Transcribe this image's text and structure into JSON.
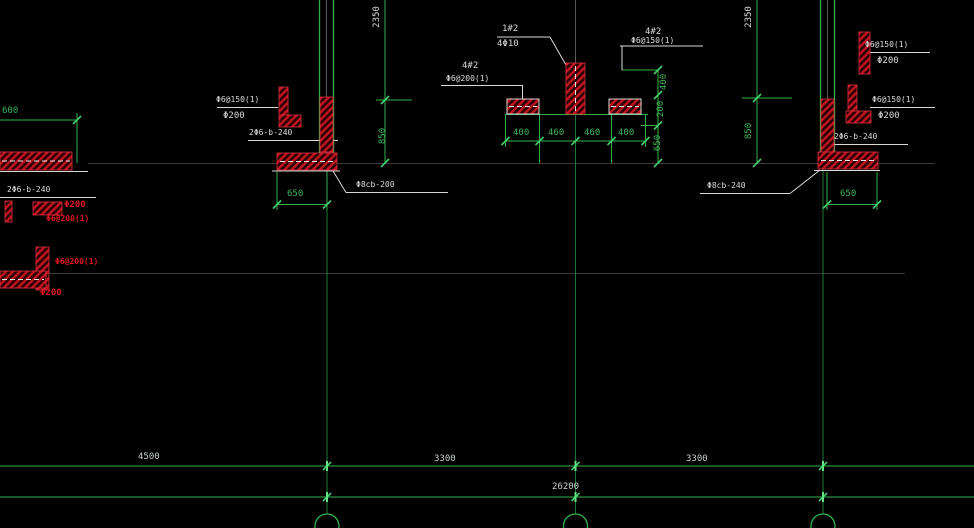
{
  "drawing": {
    "type": "cad-structural-foundation-detail",
    "palette": {
      "background": "#000000",
      "line_green": "#2fb24c",
      "axis_green_dim": "#1c7a35",
      "hatch_red": "#c41320",
      "text_white": "#dadada",
      "faint_gray": "#3c3c3c"
    }
  },
  "texts": {
    "dim_2350_left": "2350",
    "dim_2350_right": "2350",
    "dim_850_left": "850",
    "dim_850_right": "850",
    "dim_400_vert": "400",
    "dim_200_vert": "200",
    "dim_650_vert": "650",
    "dim_600": "600",
    "dim_650_left": "650",
    "dim_650_right": "650",
    "dim_400_a": "400",
    "dim_460_a": "460",
    "dim_460_b": "460",
    "dim_400_b": "400",
    "dim_4500": "4500",
    "dim_3300_left": "3300",
    "dim_3300_right": "3300",
    "dim_26200": "26200",
    "label_center_top_line1": "1#2",
    "label_center_top_line2": "4Φ10",
    "label_center_left_line1": "4#2",
    "label_center_left_line2": "Φ6@200(1)",
    "label_center_right_line1": "4#2",
    "label_center_right_line2": "Φ6@150(1)",
    "label_left_column_line1": "Φ6@150(1)",
    "label_left_column_line2": "Φ200",
    "label_right_column_line1": "Φ6@150(1)",
    "label_right_column_line2": "Φ200",
    "label_right_top_line1": "Φ6@150(1)",
    "label_right_top_line2": "Φ200",
    "label_left_footing": "2Φ6-b-240",
    "label_right_footing": "2Φ6-b-240",
    "label_edge_footing": "2Φ6-b-240",
    "label_leader_left": "Φ8cb-200",
    "label_leader_right": "Φ8cb-240",
    "label_edge_detail1_line1": "Φ200",
    "label_edge_detail1_line2": "Φ6@200(1)",
    "label_edge_detail2_line1": "Φ6@200(1)",
    "label_edge_detail2_line2": "Φ200"
  }
}
